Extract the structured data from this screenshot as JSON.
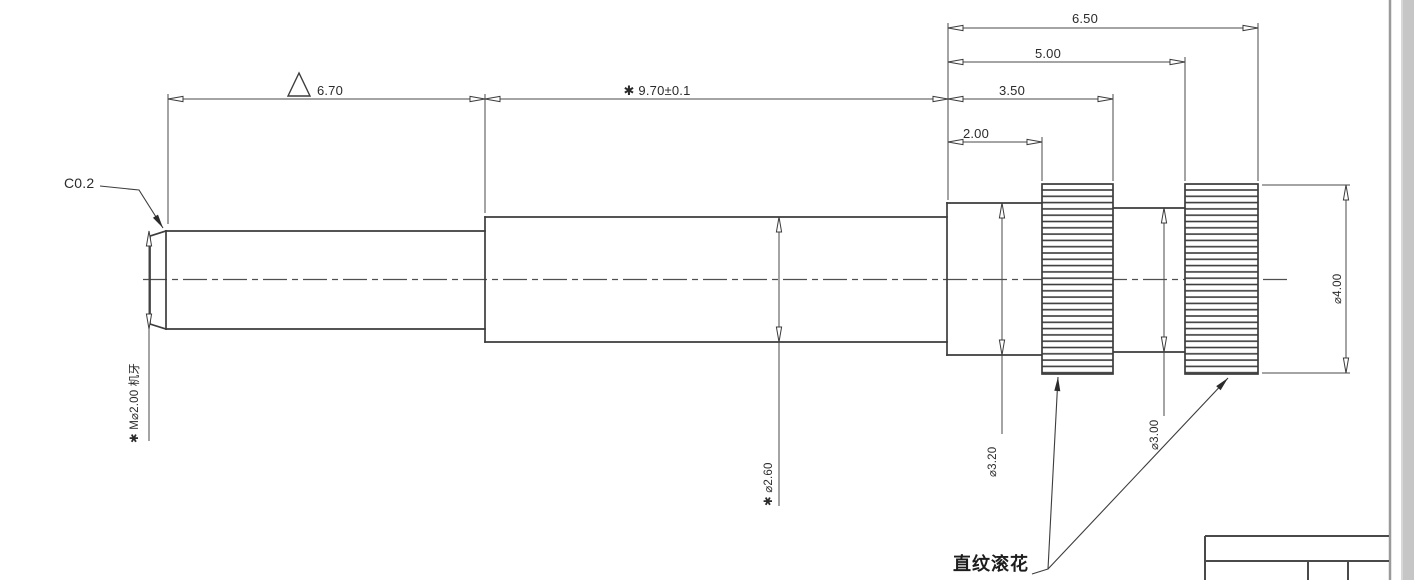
{
  "drawing": {
    "type": "mechanical-part-drawing",
    "part": "stepped shaft with threaded end and two knurled bands",
    "dims": {
      "len_6_50": "6.50",
      "len_5_00": "5.00",
      "len_3_50": "3.50",
      "len_2_00": "2.00",
      "len_6_70": "6.70",
      "len_9_70": "✱ 9.70±0.1",
      "chamfer": "C0.2",
      "thread": "✱ M⌀2.00 机牙",
      "dia_2_60": "✱ ⌀2.60",
      "dia_3_20": "⌀3.20",
      "dia_3_00": "⌀3.00",
      "dia_4_00": "⌀4.00"
    },
    "notes": {
      "knurl_label": "直纹滚花"
    },
    "symbols": [
      "triangle-flag",
      "asterisk-critical-dimension"
    ],
    "colors": {
      "outline": "#3c3c3c",
      "dimension_line": "#4a4a4a",
      "frame_edge": "#9a9a9a",
      "page_margin": "#c6c6c6",
      "background": "#ffffff",
      "text": "#2b2b2b"
    }
  }
}
